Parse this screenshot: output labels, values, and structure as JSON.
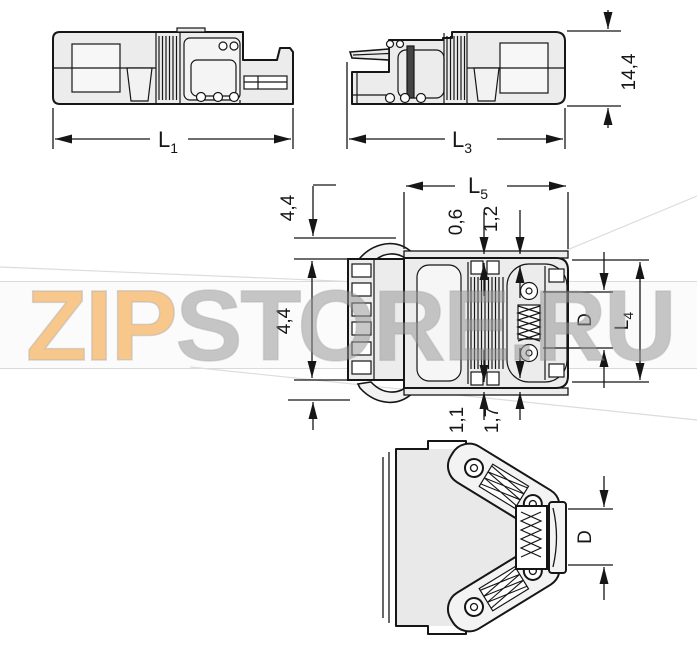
{
  "watermark": {
    "text_orange": "ZIP",
    "text_gray": "STORE.RU",
    "orange_color": "#f49d33",
    "gray_color": "#9a9a9a"
  },
  "drawing": {
    "line_color": "#161616",
    "body_fill": "#ececec",
    "labels": {
      "l1_base": "L",
      "l1_sub": "1",
      "l3_base": "L",
      "l3_sub": "3",
      "l5_base": "L",
      "l5_sub": "5",
      "l4_base": "L",
      "l4_sub": "4",
      "total_height": "14,4",
      "latch_top": "4,4",
      "latch_bottom": "4,4",
      "plate_top_a": "0,6",
      "plate_top_b": "1,2",
      "plate_bottom_a": "1,1",
      "plate_bottom_b": "1,7",
      "d_top_view": "D",
      "d_bottom_view": "D"
    }
  }
}
